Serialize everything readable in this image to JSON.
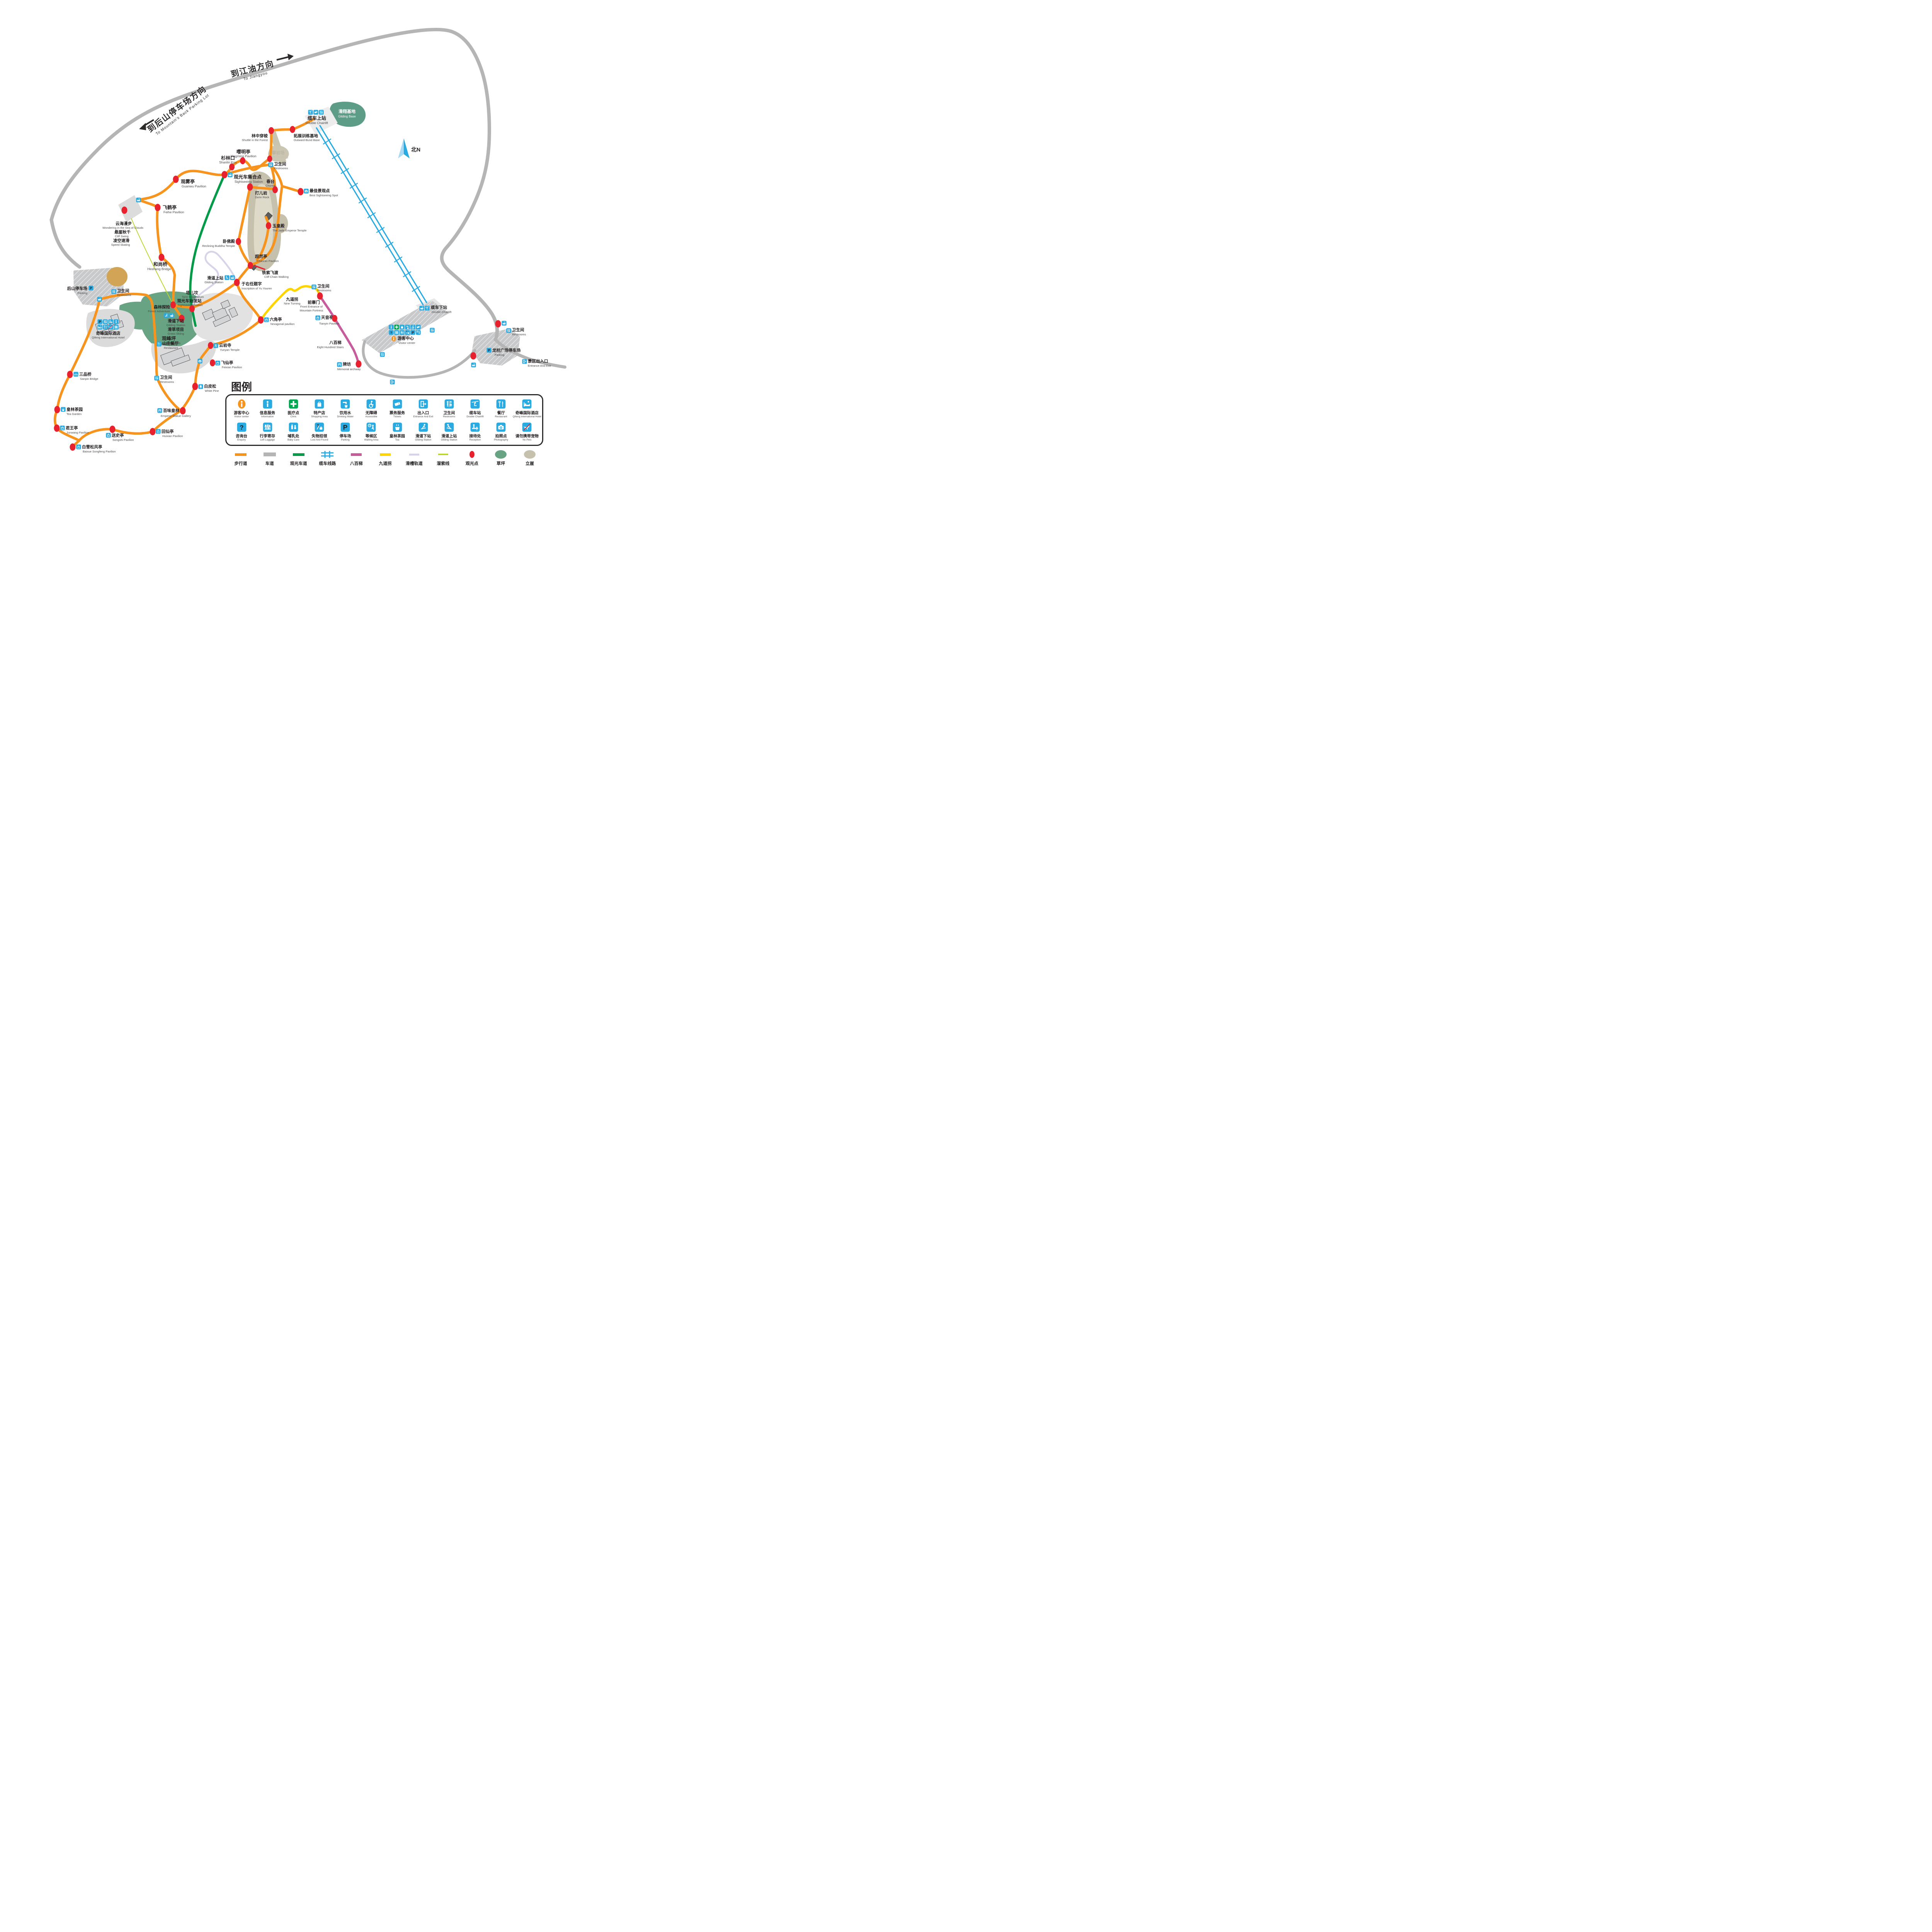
{
  "directions": {
    "jiangyou": {
      "zh": "到江油方向",
      "en": "To Jiangyou"
    },
    "back_parking": {
      "zh": "到后山停车场方向",
      "en": "To Mountain's Back Parking Lot"
    }
  },
  "compass": {
    "label": "北N"
  },
  "pois": {
    "gliding_base": {
      "zh": "滑翔基地",
      "en": "Gliding Base"
    },
    "cable_top": {
      "zh": "缆车上站",
      "en": "Double Chairlift"
    },
    "outward": {
      "zh": "拓展训练基地",
      "en": "Outward-Bund Base"
    },
    "shuttle": {
      "zh": "林中穿梭",
      "en": "Shuttle in the Forest"
    },
    "rock_climbing": {
      "zh": "攀岩场",
      "en": "Rock Climbing"
    },
    "yingming": {
      "zh": "嘤明亭",
      "en": "Yingming Pavilion"
    },
    "shanlinkou": {
      "zh": "杉林口",
      "en": "Shanlin Kou"
    },
    "meeting": {
      "zh": "观光车集合点",
      "en": "Sightseeing Station"
    },
    "restroom": {
      "zh": "卫生间",
      "en": "Restrooms"
    },
    "chuntai": {
      "zh": "春台",
      "en": "Chuntai"
    },
    "daer": {
      "zh": "打儿岩",
      "en": "Da'er Rock"
    },
    "best_spot": {
      "zh": "最佳景观点",
      "en": "Best Sightseeing Spot"
    },
    "jade": {
      "zh": "玉皇殿",
      "en": "The Jade Emperor Temple"
    },
    "guanwu": {
      "zh": "观雾亭",
      "en": "Guanwu Pavilion"
    },
    "feihe": {
      "zh": "飞鹤亭",
      "en": "Feihe Pavilion"
    },
    "sea_clouds": {
      "zh": "云海漫步",
      "en": "Wondering in the Sea of Clouds"
    },
    "cliff_swing": {
      "zh": "悬崖秋千",
      "en": "Cliff Swing"
    },
    "speed_skating": {
      "zh": "凌空速滑",
      "en": "Speed Skating"
    },
    "heshang": {
      "zh": "和尚桥",
      "en": "Heshang Bridge"
    },
    "wofodian": {
      "zh": "卧佛殿",
      "en": "Reclining Buddha Temple"
    },
    "chaoran": {
      "zh": "超然亭",
      "en": "Chaoran Pavilion"
    },
    "tiesuo": {
      "zh": "铁索飞渡",
      "en": "Cliff Chain Walking"
    },
    "glide_top": {
      "zh": "滑道上站",
      "en": "Gliding Station"
    },
    "yu_youren": {
      "zh": "于右任题字",
      "en": "Inscription of Yu Youren"
    },
    "taer": {
      "zh": "塔儿坟",
      "en": "Ta'er Mausoleum"
    },
    "start_station": {
      "zh": "观光车始发站",
      "en": "Sightseeing Station"
    },
    "forest_adv": {
      "zh": "森林探险",
      "en": "Forest Adventure"
    },
    "glide_bottom": {
      "zh": "滑道下站",
      "en": "Gliding Station"
    },
    "grass_ski": {
      "zh": "滑草项目",
      "en": "Grass Skiing"
    },
    "lawn": {
      "zh": "观峰坪",
      "en": "Guanfeng Lawn"
    },
    "houshan_parking": {
      "zh": "后山停车场",
      "en": "Parking"
    },
    "hotel": {
      "zh": "奇峰国际酒店",
      "en": "Qifeng International Hotel"
    },
    "restaurant": {
      "zh": "山庄餐厅",
      "en": "Restaurant"
    },
    "yunyan": {
      "zh": "云岩寺",
      "en": "Yunyan Temple"
    },
    "feixian": {
      "zh": "飞仙亭",
      "en": "Feixian Pavilion"
    },
    "white_pine": {
      "zh": "白皮松",
      "en": "White Pine"
    },
    "emperor_gallery": {
      "zh": "百味皇林",
      "en": "Emperor Statue Gallery"
    },
    "sanpin": {
      "zh": "三品桥",
      "en": "Sanpin Bridge"
    },
    "tea_garden": {
      "zh": "皇林茶园",
      "en": "Tea Garden"
    },
    "junwang": {
      "zh": "君王亭",
      "en": "Junwang Pavilion"
    },
    "baixue": {
      "zh": "白雪松风亭",
      "en": "Baixue Songfeng Pavilion"
    },
    "songshi": {
      "zh": "送史亭",
      "en": "Songshi Pavilion"
    },
    "huixian": {
      "zh": "回仙亭",
      "en": "Huixian Pavilion"
    },
    "hexagonal": {
      "zh": "六角亭",
      "en": "hexagonal pavilion"
    },
    "nine_turning": {
      "zh": "九道拐",
      "en": "Nine Turning"
    },
    "qianzhaimen": {
      "zh": "前寨门",
      "en": "Front Entrance of",
      "en2": "Mountain Fortress"
    },
    "tianyin": {
      "zh": "天音亭",
      "en": "Tianyin Pavilion"
    },
    "eight_hundred": {
      "zh": "八百梯",
      "en": "Eight Hundred Stairs"
    },
    "memorial": {
      "zh": "牌坊",
      "en": "Memorial archway"
    },
    "visitor_center": {
      "zh": "游客中心",
      "en": "Visitor center"
    },
    "cable_bottom": {
      "zh": "缆车下站",
      "en": "Double Chairlift"
    },
    "longzhu_parking": {
      "zh": "龙柱广场停车场",
      "en": "Parking"
    },
    "entrance": {
      "zh": "景区出入口",
      "en": "Entrance And Exit"
    }
  },
  "legend": {
    "title": "图例",
    "row1": [
      {
        "zh": "游客中心",
        "en": "Visitor center",
        "icon": "visitor",
        "color": "#F7941E"
      },
      {
        "zh": "信息服务",
        "en": "Information",
        "icon": "info",
        "color": "#29ABE2"
      },
      {
        "zh": "医疗点",
        "en": "Clinic",
        "icon": "clinic",
        "color": "#00A651"
      },
      {
        "zh": "特产店",
        "en": "Shopping Area",
        "icon": "shop",
        "color": "#29ABE2"
      },
      {
        "zh": "饮用水",
        "en": "Drinking Water",
        "icon": "water",
        "color": "#29ABE2"
      },
      {
        "zh": "无障碍",
        "en": "Accessible",
        "icon": "access",
        "color": "#29ABE2"
      },
      {
        "zh": "票务服务",
        "en": "Tickets",
        "icon": "ticket",
        "color": "#29ABE2"
      },
      {
        "zh": "出入口",
        "en": "Entrance And Exit",
        "icon": "exit",
        "color": "#29ABE2"
      },
      {
        "zh": "卫生间",
        "en": "Restrooms",
        "icon": "restroom",
        "color": "#29ABE2"
      },
      {
        "zh": "缆车站",
        "en": "Double Chairlift",
        "icon": "lift",
        "color": "#29ABE2"
      },
      {
        "zh": "餐厅",
        "en": "Restaurant",
        "icon": "rest",
        "color": "#29ABE2"
      },
      {
        "zh": "奇峰国际酒店",
        "en": "Qifeng International Hotel",
        "icon": "hotel",
        "color": "#29ABE2"
      }
    ],
    "row2": [
      {
        "zh": "咨询台",
        "en": "Enquiry",
        "icon": "enquiry",
        "color": "#29ABE2"
      },
      {
        "zh": "行李寄存",
        "en": "Left Luggage",
        "icon": "luggage",
        "color": "#29ABE2"
      },
      {
        "zh": "哺乳处",
        "en": "Baby Care",
        "icon": "baby",
        "color": "#29ABE2"
      },
      {
        "zh": "失物招领",
        "en": "Lost And Found",
        "icon": "lost",
        "color": "#29ABE2"
      },
      {
        "zh": "停车场",
        "en": "Parking",
        "icon": "park",
        "color": "#29ABE2"
      },
      {
        "zh": "等候区",
        "en": "Waiting Area",
        "icon": "wait",
        "color": "#29ABE2"
      },
      {
        "zh": "皇林茶园",
        "en": "Tea",
        "icon": "tea",
        "color": "#29ABE2"
      },
      {
        "zh": "滑道下站",
        "en": "Gliding Station",
        "icon": "skidown",
        "color": "#29ABE2"
      },
      {
        "zh": "滑道上站",
        "en": "Gliding Station",
        "icon": "skiup",
        "color": "#29ABE2"
      },
      {
        "zh": "接待处",
        "en": "Reception",
        "icon": "reception",
        "color": "#29ABE2"
      },
      {
        "zh": "拍照点",
        "en": "Photography",
        "icon": "photo",
        "color": "#29ABE2"
      },
      {
        "zh": "请勿携带宠物",
        "en": "No Pets",
        "icon": "nopets",
        "color": "#29ABE2"
      }
    ],
    "lines": [
      {
        "zh": "步行道",
        "type": "walk",
        "color": "#F7941E"
      },
      {
        "zh": "车道",
        "type": "road",
        "color": "#B5B5B5"
      },
      {
        "zh": "观光车道",
        "type": "busroad",
        "color": "#009A49"
      },
      {
        "zh": "缆车线路",
        "type": "cable",
        "color": "#29ABE2"
      },
      {
        "zh": "八百梯",
        "type": "stairs",
        "color": "#C75B9B"
      },
      {
        "zh": "九道拐",
        "type": "nineturn",
        "color": "#FFD500"
      },
      {
        "zh": "滑槽轨道",
        "type": "chute",
        "color": "#D8D3E8"
      },
      {
        "zh": "溜索线",
        "type": "zipline",
        "color": "#BCD635"
      },
      {
        "zh": "观光点",
        "type": "spot",
        "color": "#E8212E"
      },
      {
        "zh": "草坪",
        "type": "lawn",
        "color": "#68A383"
      },
      {
        "zh": "立崖",
        "type": "cliff",
        "color": "#C6C1AD"
      }
    ]
  },
  "colors": {
    "walk_path": "#F7941E",
    "road": "#B5B5B5",
    "bus_road": "#009A49",
    "cable": "#29ABE2",
    "stairs_800": "#C75B9B",
    "nine_turning": "#FFD500",
    "chute": "#D8D3E8",
    "zipline": "#BCD635",
    "poi_dot": "#E8212E",
    "lawn": "#68A383",
    "cliff": "#C6C1AD",
    "icon_blue": "#29ABE2",
    "visitor_orange": "#F7941E",
    "clinic_green": "#00A651"
  }
}
